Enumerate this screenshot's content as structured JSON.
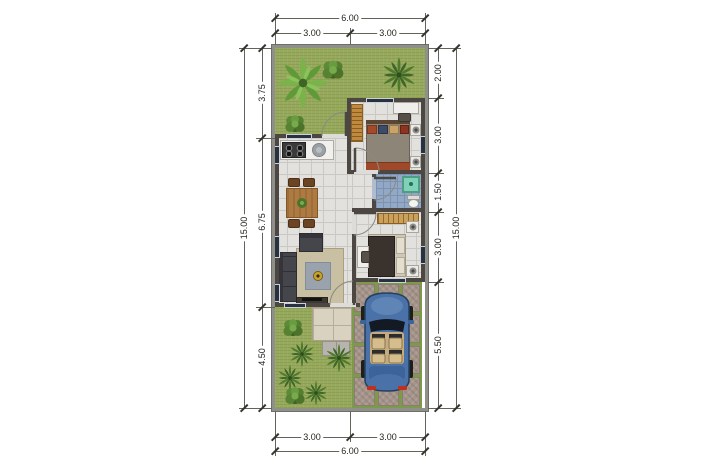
{
  "plan": {
    "kind": "house-floor-plan"
  },
  "dims": {
    "top": {
      "total": "6.00",
      "segments": [
        "3.00",
        "3.00"
      ]
    },
    "bottom": {
      "total": "6.00",
      "segments": [
        "3.00",
        "3.00"
      ]
    },
    "left": {
      "total": "15.00",
      "segments": [
        "3.75",
        "6.75",
        "4.50"
      ]
    },
    "right": {
      "total": "15.00",
      "segments": [
        "2.00",
        "3.00",
        "1.50",
        "3.00",
        "5.50"
      ]
    }
  },
  "colors": {
    "grass": "#97a95e",
    "wall": "#4c4742",
    "floor_tile": "#e2e1dd",
    "bathroom_tile": "#92a8c5",
    "terrace": "#d9d2c1",
    "paver": "#a5948a",
    "car_body": "#4a72a8",
    "wood": "#b07d42",
    "shower": "#7fd2b8",
    "dimension_text": "#26261f"
  }
}
